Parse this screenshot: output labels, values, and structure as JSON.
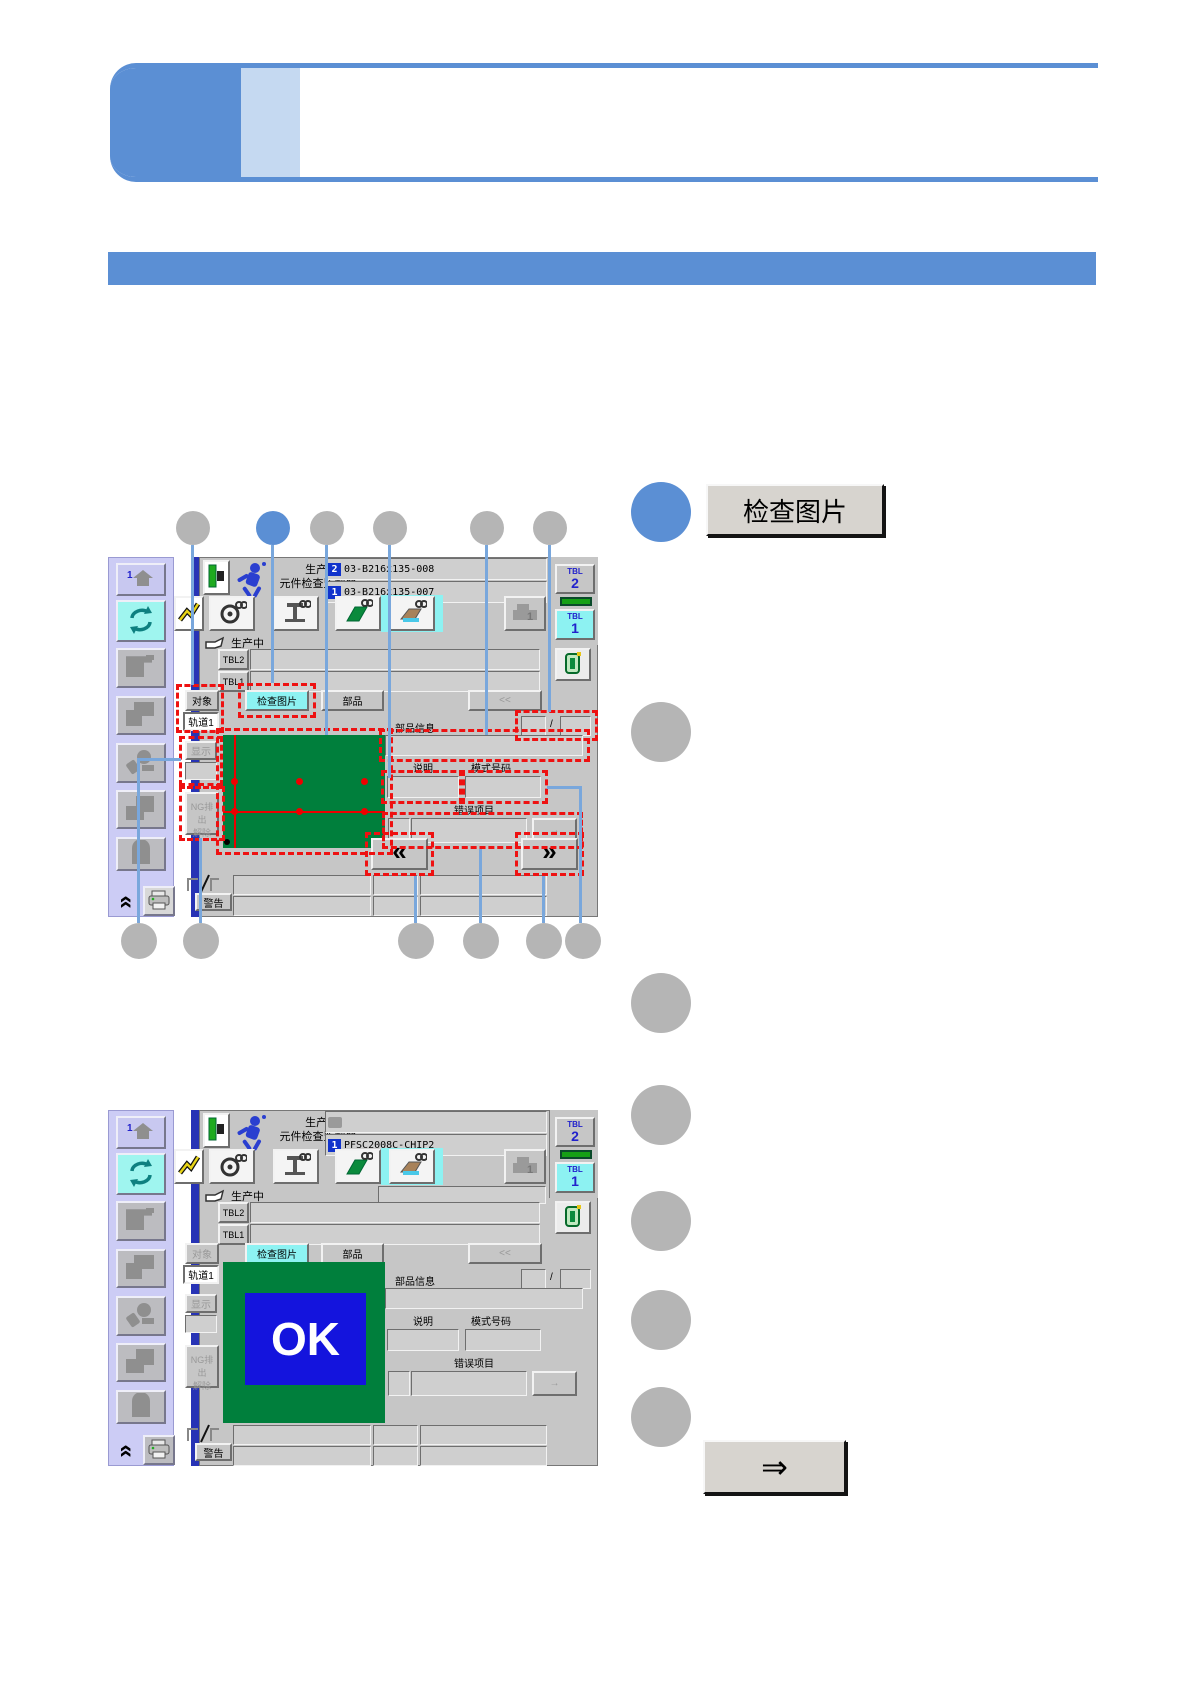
{
  "side_panel": {
    "inspect_image_button": "检查图片",
    "proceed_button": "⇒"
  },
  "ui": {
    "title_line1": "生产-",
    "title_line2": "元件检查监视器",
    "status": "生产中",
    "tbl_label": "TBL",
    "tbl2_num": "2",
    "tbl1_num": "1",
    "tbl2_row": "TBL2",
    "tbl1_row": "TBL1",
    "target": "对象",
    "track1": "轨道1",
    "inspect_picture": "检查图片",
    "part": "部品",
    "collapse": "<<",
    "part_info": "部品信息",
    "slash": "/",
    "display": "显示",
    "ng_discharge": "NG排出",
    "ng_release": "解除",
    "description": "说明",
    "mode_number": "模式号码",
    "error_item": "错误项目",
    "arrow_right": "→",
    "page_prev": "«",
    "page_next": "»",
    "warning": "警告"
  },
  "screen1": {
    "program2_badge": "2",
    "program2": "03-B216x135-008",
    "program1_badge": "1",
    "program1": "03-B216x135-007"
  },
  "screen2": {
    "program1_badge": "1",
    "program1": "PFSC2008C-CHIP2",
    "ok": "OK"
  },
  "colors": {
    "accent_blue": "#5b8fd4",
    "accent_light_blue": "#c5d9f1",
    "callout_gray": "#b5b5b5",
    "highlight_cyan": "#8df2f2",
    "pcb_green": "#007f3c",
    "ok_blue": "#1414dd",
    "dash_red": "#ee1111"
  }
}
